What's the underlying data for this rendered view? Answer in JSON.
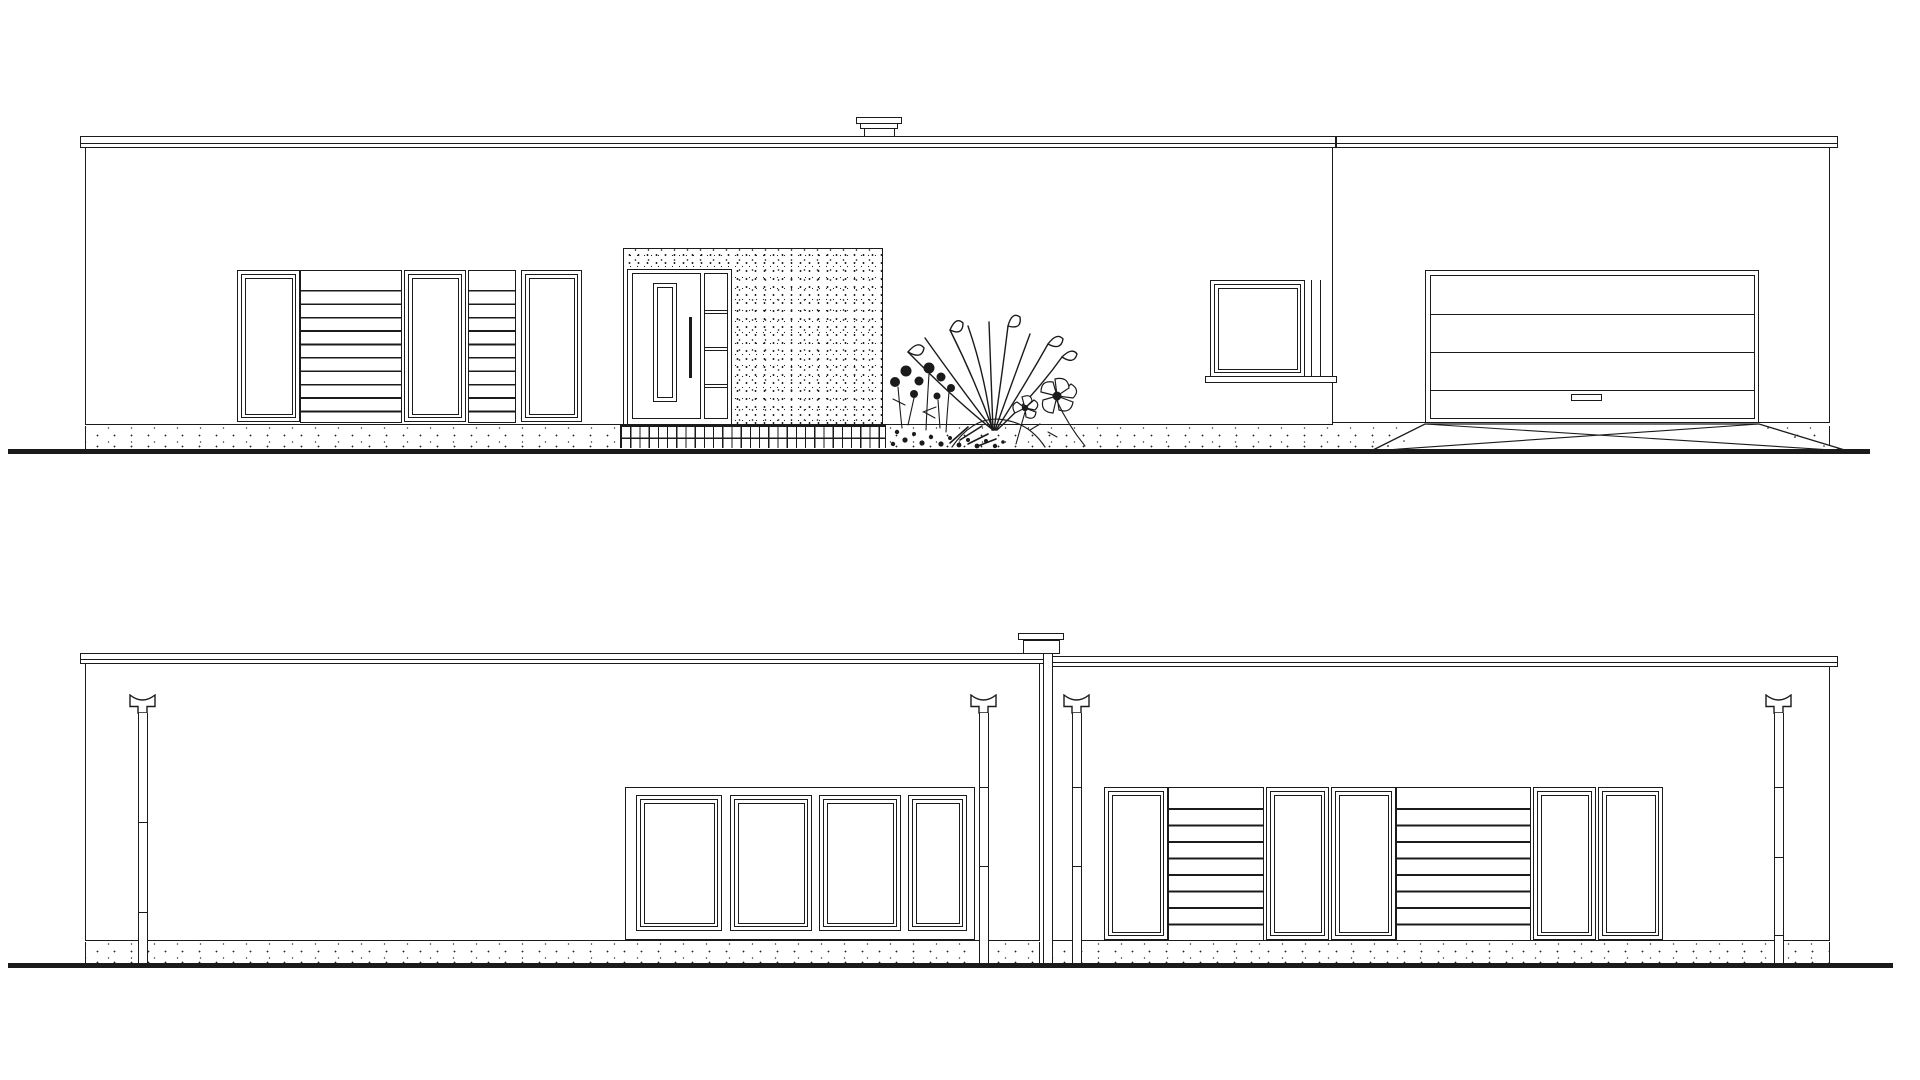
{
  "drawing": {
    "background": "#ffffff",
    "line_color": "#1b1b1b",
    "views": [
      {
        "id": "front",
        "label": "front elevation with entry, planting bed and garage wing"
      },
      {
        "id": "rear",
        "label": "rear elevation in two wings with chimney flue and four downspouts"
      }
    ]
  },
  "front": {
    "band": {
      "top": 270,
      "height": 152
    },
    "louver_cfg": {
      "pitch": 13.4,
      "offset": 19,
      "line": 1.7
    },
    "openings": [
      {
        "kind": "window",
        "x": 237,
        "w": 63
      },
      {
        "kind": "louver",
        "x": 300,
        "w": 102
      },
      {
        "kind": "window",
        "x": 404,
        "w": 62
      },
      {
        "kind": "louver",
        "x": 468,
        "w": 48
      },
      {
        "kind": "window",
        "x": 521,
        "w": 61
      }
    ],
    "entry": {
      "doors": 1,
      "sidelight_rails": 3,
      "glass_slot": 1,
      "handle": 1
    },
    "small_window": {
      "count": 1,
      "sill": 1
    },
    "garage": {
      "door_panels": 4,
      "handle": 1,
      "driveway_diagonals": 2
    },
    "chimney": {
      "count": 1
    },
    "plants": [
      "rose-bush",
      "ground-cover",
      "yucca",
      "hellebore-flowers"
    ]
  },
  "rear": {
    "band": {
      "top": 787,
      "height": 153
    },
    "louver_cfg": {
      "pitch": 16.5,
      "offset": 20,
      "line": 1.8
    },
    "slider": {
      "x": 625,
      "w": 350,
      "panels": [
        {
          "x": 10,
          "w": 86
        },
        {
          "x": 104,
          "w": 82
        },
        {
          "x": 193,
          "w": 82
        },
        {
          "x": 282,
          "w": 59
        }
      ]
    },
    "openings": [
      {
        "kind": "window",
        "x": 1104,
        "w": 64
      },
      {
        "kind": "louver",
        "x": 1168,
        "w": 96
      },
      {
        "kind": "window",
        "x": 1266,
        "w": 63
      },
      {
        "kind": "window",
        "x": 1331,
        "w": 65
      },
      {
        "kind": "louver",
        "x": 1396,
        "w": 135
      },
      {
        "kind": "window",
        "x": 1533,
        "w": 63
      },
      {
        "kind": "window",
        "x": 1598,
        "w": 65
      }
    ],
    "downspouts": [
      {
        "id": "rear-left-wing-left",
        "funnel_x": 129,
        "pipe_x": 138,
        "joints": [
          109,
          199
        ]
      },
      {
        "id": "rear-left-wing-right",
        "funnel_x": 970,
        "pipe_x": 979,
        "joints": [
          74,
          153
        ]
      },
      {
        "id": "rear-right-wing-left",
        "funnel_x": 1063,
        "pipe_x": 1072,
        "joints": [
          74,
          153
        ]
      },
      {
        "id": "rear-right-wing-right",
        "funnel_x": 1765,
        "pipe_x": 1774,
        "joints": [
          74,
          144,
          222
        ]
      }
    ],
    "chimney": {
      "count": 1,
      "flue_to_ground": true
    }
  }
}
